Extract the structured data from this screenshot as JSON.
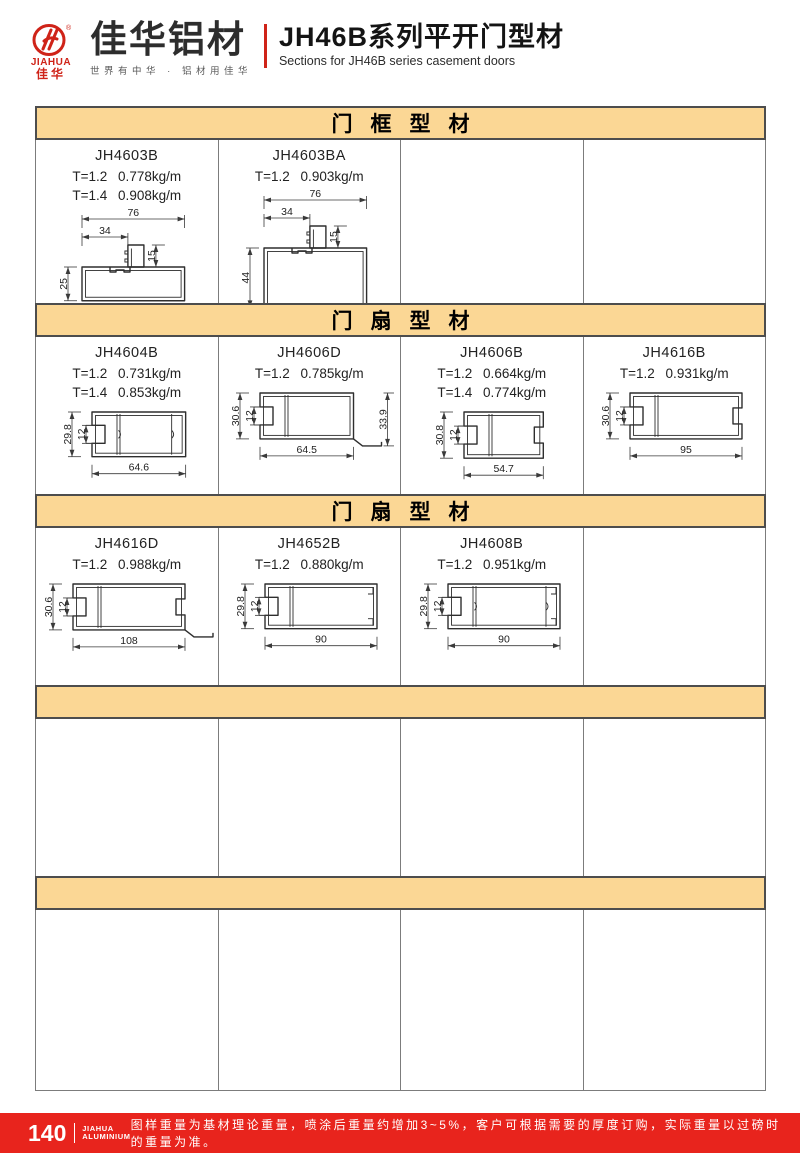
{
  "header": {
    "logo_en": "JIAHUA",
    "logo_cn": "佳华",
    "brand_name": "佳华铝材",
    "brand_tagline": "世界有中华 · 铝材用佳华",
    "title_cn": "JH46B系列平开门型材",
    "title_en": "Sections for JH46B series casement doors"
  },
  "colors": {
    "accent_red": "#e8241d",
    "band_tan": "#fbd795",
    "line_dark": "#2e2e2e"
  },
  "sections": [
    {
      "band_label": "门框型材",
      "cells": [
        {
          "code": "JH4603B",
          "weights": [
            "T=1.2 0.778kg/m",
            "T=1.4 0.908kg/m"
          ],
          "drawing": {
            "type": "frame",
            "overall_w": "76",
            "part_w": "34",
            "flange_h": "15",
            "height": "25"
          }
        },
        {
          "code": "JH4603BA",
          "weights": [
            "T=1.2 0.903kg/m"
          ],
          "drawing": {
            "type": "frame",
            "overall_w": "76",
            "part_w": "34",
            "flange_h": "15",
            "height": "44"
          }
        },
        {},
        {}
      ]
    },
    {
      "band_label": "门扇型材",
      "cells": [
        {
          "code": "JH4604B",
          "weights": [
            "T=1.2 0.731kg/m",
            "T=1.4 0.853kg/m"
          ],
          "drawing": {
            "type": "sash",
            "height": "29.8",
            "groove": "12",
            "width": "64.6",
            "clips": true
          }
        },
        {
          "code": "JH4606D",
          "weights": [
            "T=1.2 0.785kg/m"
          ],
          "drawing": {
            "type": "sash",
            "height": "30.6",
            "groove": "12",
            "width": "64.5",
            "right_h": "33.9",
            "step": true
          }
        },
        {
          "code": "JH4606B",
          "weights": [
            "T=1.2 0.664kg/m",
            "T=1.4 0.774kg/m"
          ],
          "drawing": {
            "type": "sash",
            "height": "30.8",
            "groove": "12",
            "width": "54.7",
            "right_notch": true
          }
        },
        {
          "code": "JH4616B",
          "weights": [
            "T=1.2 0.931kg/m"
          ],
          "drawing": {
            "type": "sash",
            "height": "30.6",
            "groove": "12",
            "width": "95",
            "right_notch": true
          }
        }
      ]
    },
    {
      "band_label": "门扇型材",
      "cells": [
        {
          "code": "JH4616D",
          "weights": [
            "T=1.2 0.988kg/m"
          ],
          "drawing": {
            "type": "sash",
            "height": "30.6",
            "groove": "12",
            "width": "108",
            "right_notch": true,
            "step": true
          }
        },
        {
          "code": "JH4652B",
          "weights": [
            "T=1.2 0.880kg/m"
          ],
          "drawing": {
            "type": "sash",
            "height": "29.8",
            "groove": "12",
            "width": "90",
            "hooks": true
          }
        },
        {
          "code": "JH4608B",
          "weights": [
            "T=1.2 0.951kg/m"
          ],
          "drawing": {
            "type": "sash",
            "height": "29.8",
            "groove": "12",
            "width": "90",
            "hooks": true,
            "clips": true
          }
        },
        {}
      ]
    },
    {
      "band_label": "",
      "cells": [
        {},
        {},
        {},
        {}
      ]
    },
    {
      "band_label": "",
      "cells": [
        {},
        {},
        {},
        {}
      ]
    }
  ],
  "footer": {
    "page_number": "140",
    "brand_line1": "JIAHUA",
    "brand_line2": "ALUMINIUM",
    "note": "图样重量为基材理论重量，喷涂后重量约增加3~5%，客户可根据需要的厚度订购，实际重量以过磅时的重量为准。"
  }
}
